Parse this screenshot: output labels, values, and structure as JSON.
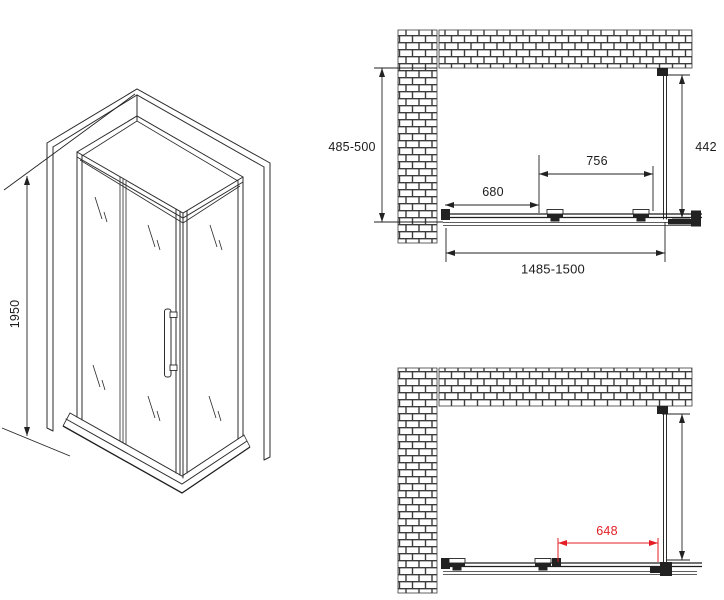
{
  "drawing": {
    "type": "shower-enclosure-technical-drawing",
    "colors": {
      "line": "#2b2b2b",
      "dimension_text": "#1c1c1c",
      "dimension_red": "#e31e24",
      "background": "#ffffff"
    },
    "isometric_view": {
      "height_label": "1950"
    },
    "plan_view_closed": {
      "depth_label": "485-500",
      "side_panel_label": "442",
      "door_width_label": "756",
      "fixed_width_label": "680",
      "total_width_label": "1485-1500"
    },
    "plan_view_open": {
      "opening_label": "648"
    }
  }
}
